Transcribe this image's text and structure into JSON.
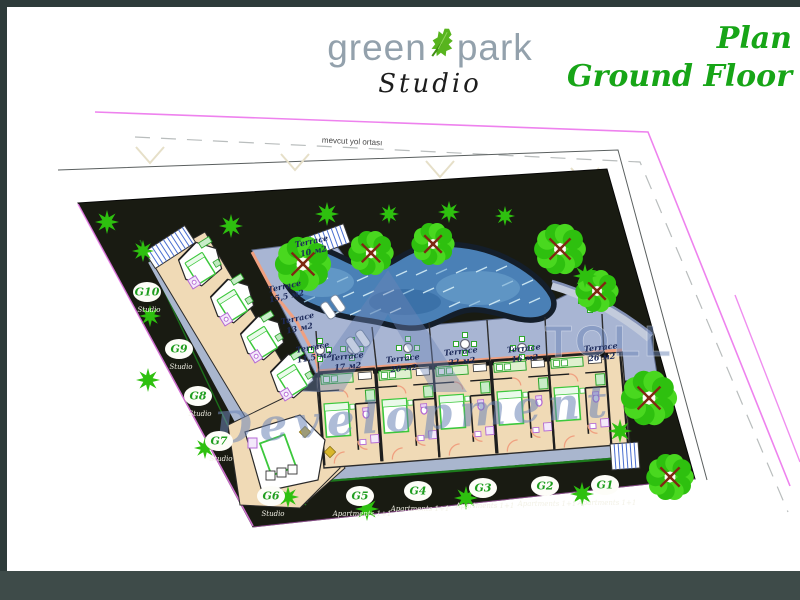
{
  "header": {
    "logo": {
      "word1": "green",
      "word2": "park",
      "subtitle": "Studio"
    },
    "title_line1": "Plan",
    "title_line2": "Ground Floor"
  },
  "road_label": "mevcut yol ortası",
  "watermark": {
    "brand": "TOLL",
    "script": "Development"
  },
  "site": {
    "terrace_word": "Terrace",
    "terraces": [
      {
        "area": "10 м2",
        "x": 312,
        "y": 244,
        "rot": -12
      },
      {
        "area": "15,5 м2",
        "x": 285,
        "y": 289,
        "rot": -12
      },
      {
        "area": "13 м2",
        "x": 298,
        "y": 321,
        "rot": -12
      },
      {
        "area": "11,5 м2",
        "x": 313,
        "y": 350,
        "rot": -10
      },
      {
        "area": "17 м2",
        "x": 347,
        "y": 359,
        "rot": -6
      },
      {
        "area": "20 м2",
        "x": 403,
        "y": 361,
        "rot": -6
      },
      {
        "area": "22 м2",
        "x": 461,
        "y": 354,
        "rot": -6
      },
      {
        "area": "16 м2",
        "x": 524,
        "y": 351,
        "rot": -6
      },
      {
        "area": "26 м2",
        "x": 601,
        "y": 350,
        "rot": -6
      }
    ],
    "units": [
      {
        "id": "G10",
        "type": "Studio",
        "x": 147,
        "y": 292
      },
      {
        "id": "G9",
        "type": "Studio",
        "x": 179,
        "y": 349
      },
      {
        "id": "G8",
        "type": "Studio",
        "x": 198,
        "y": 396
      },
      {
        "id": "G7",
        "type": "Studio",
        "x": 219,
        "y": 441
      },
      {
        "id": "G6",
        "type": "Studio",
        "x": 271,
        "y": 496
      },
      {
        "id": "G5",
        "type": "Apartments 1+1",
        "x": 360,
        "y": 496
      },
      {
        "id": "G4",
        "type": "Apartments 1+1",
        "x": 418,
        "y": 491
      },
      {
        "id": "G3",
        "type": "Apartments 1+1",
        "x": 483,
        "y": 488
      },
      {
        "id": "G2",
        "type": "Apartments 1+1",
        "x": 545,
        "y": 486
      },
      {
        "id": "G1",
        "type": "Apartments 1+1",
        "x": 605,
        "y": 485
      }
    ]
  },
  "colors": {
    "title_green": "#17a517",
    "logo_gray": "#93a1ac",
    "leaf_green": "#58b41e",
    "magenta": "#ee82ee",
    "site_dark": "#191b12",
    "building_beige": "#f0dab6",
    "terrace_blue": "#a8b5d3",
    "walkway_blue": "#a9b6ce",
    "pool_water": "#4a80b6",
    "pool_outline": "#141e2a",
    "tree_green": "#2ec00f",
    "peach": "#f0a080",
    "furniture_green": "#3cc83c",
    "fixture_purple": "#b469d4",
    "hedge_green": "#1c7a1c",
    "watermark_blue": "#6d86b8",
    "label_navy": "#1d2a5a",
    "badge_green": "#1f9e1f"
  }
}
